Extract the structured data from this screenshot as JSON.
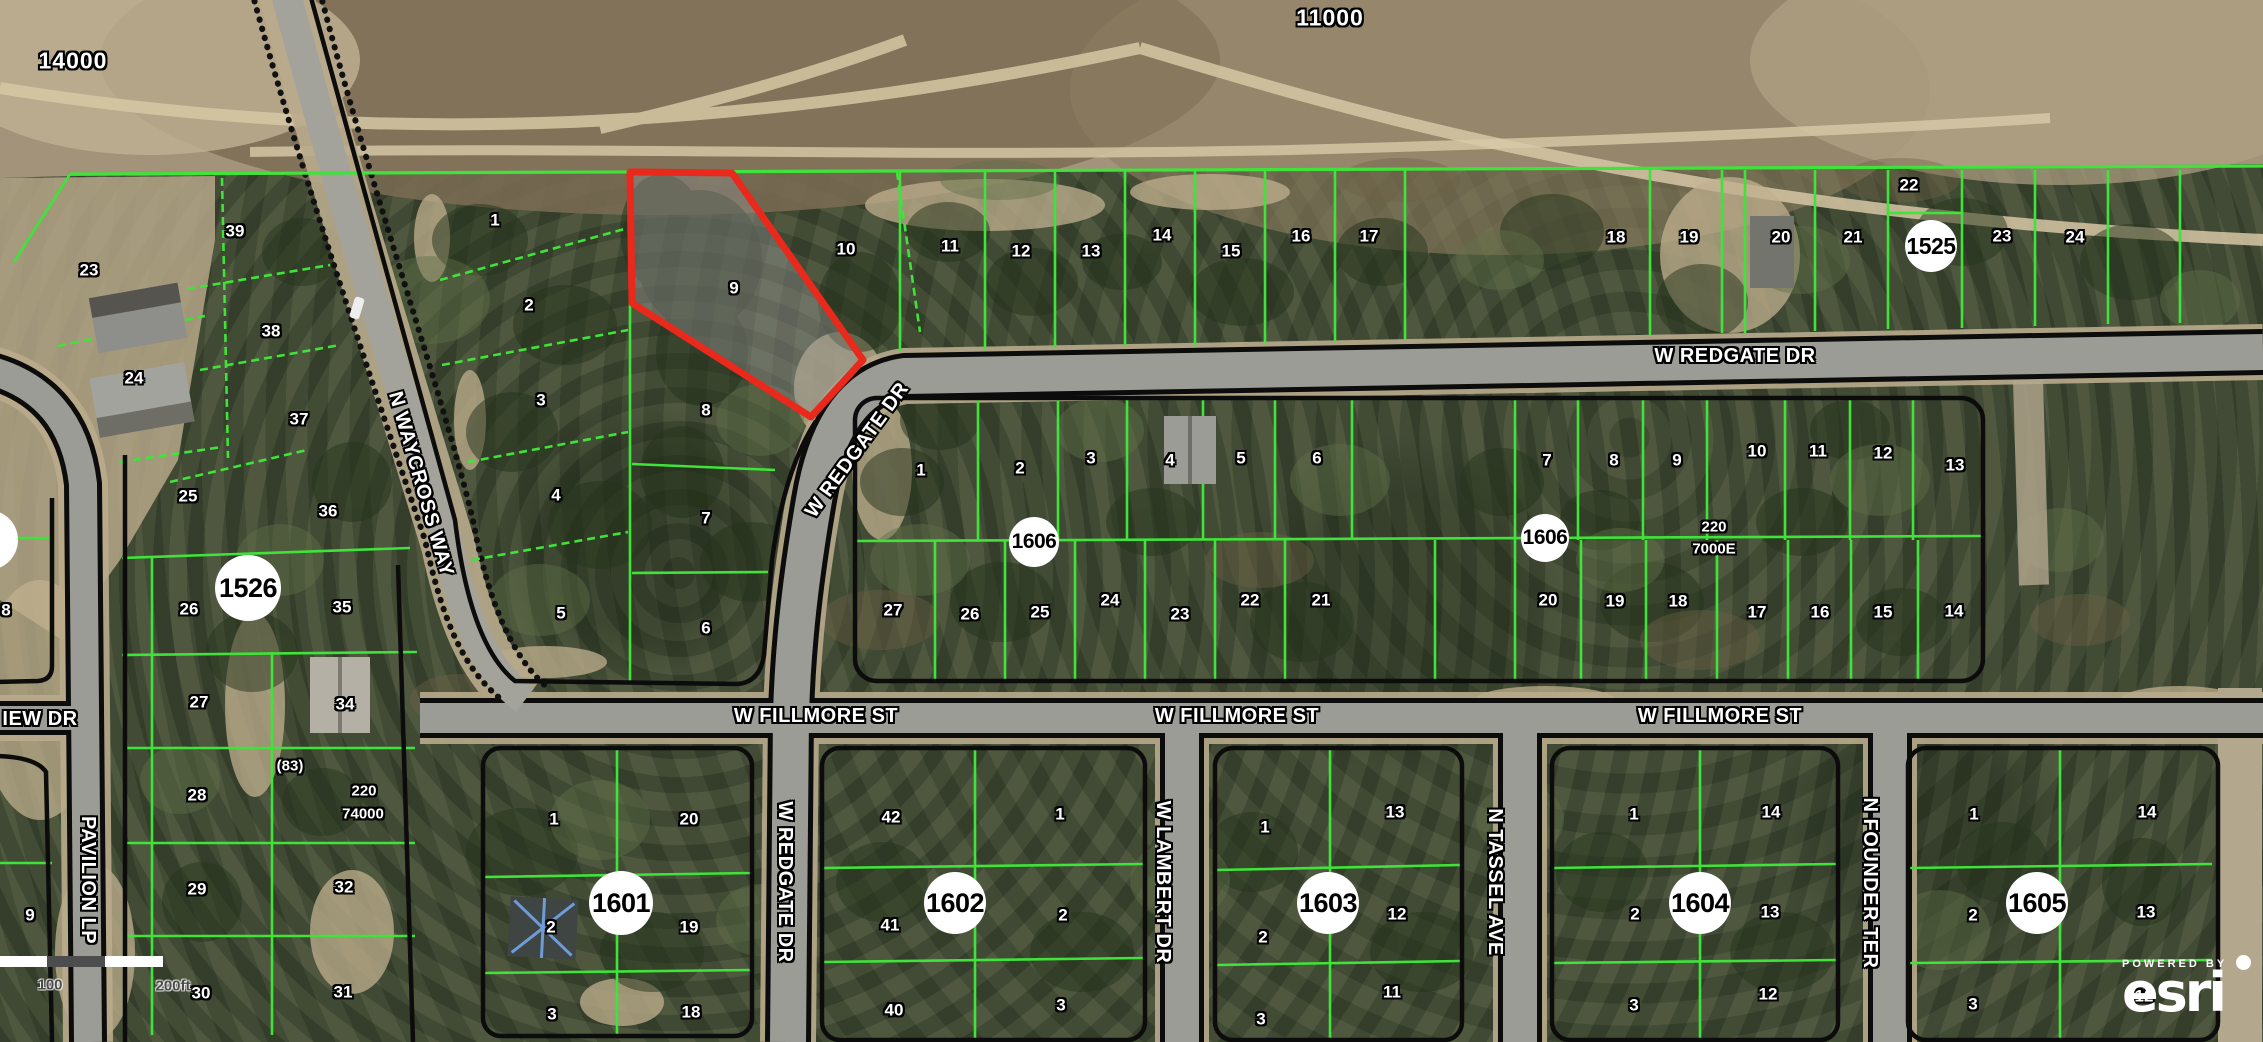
{
  "attribution": {
    "powered_by": "POWERED BY",
    "brand": "esri"
  },
  "scale_bar": {
    "labels": [
      {
        "t": "100",
        "x": 50,
        "y": 985
      },
      {
        "t": "200ft",
        "x": 173,
        "y": 986
      }
    ]
  },
  "colors": {
    "parcel_line": "#3fe339",
    "block_outline": "#0c0c0c",
    "highlight_stroke": "#e8291c",
    "highlight_fill": "rgba(150,150,150,0.42)",
    "road": "#9c9c96",
    "sand": "#c0b08f",
    "badge_bg": "#ffffff"
  },
  "highlighted_parcel": {
    "lot": "9"
  },
  "area_labels": [
    {
      "t": "14000",
      "x": 73,
      "y": 61
    },
    {
      "t": "11000",
      "x": 1330,
      "y": 18
    }
  ],
  "street_labels": [
    {
      "t": "N WAYCROSS WAY",
      "x": 421,
      "y": 484,
      "rot": 74
    },
    {
      "t": "W REDGATE DR",
      "x": 857,
      "y": 450,
      "rot": -54
    },
    {
      "t": "W REDGATE DR",
      "x": 1735,
      "y": 356,
      "rot": 0
    },
    {
      "t": "W REDGATE DR",
      "x": 785,
      "y": 882,
      "rot": 90
    },
    {
      "t": "W FILLMORE ST",
      "x": 816,
      "y": 716,
      "rot": 0
    },
    {
      "t": "W FILLMORE ST",
      "x": 1237,
      "y": 716,
      "rot": 0
    },
    {
      "t": "W FILLMORE ST",
      "x": 1720,
      "y": 716,
      "rot": 0
    },
    {
      "t": "W LAMBERT DR",
      "x": 1163,
      "y": 882,
      "rot": 90
    },
    {
      "t": "N TASSEL AVE",
      "x": 1495,
      "y": 882,
      "rot": 90
    },
    {
      "t": "N FOUNDER TER",
      "x": 1870,
      "y": 883,
      "rot": 90
    },
    {
      "t": "PAVILION LP",
      "x": 88,
      "y": 880,
      "rot": 90
    },
    {
      "t": "IEW DR",
      "x": 40,
      "y": 719,
      "rot": 0
    }
  ],
  "block_badges": [
    {
      "t": "1526",
      "x": 248,
      "y": 588,
      "r": 33
    },
    {
      "t": "1525",
      "x": 1931,
      "y": 246,
      "r": 26
    },
    {
      "t": "1606",
      "x": 1034,
      "y": 542,
      "r": 25
    },
    {
      "t": "1606",
      "x": 1545,
      "y": 538,
      "r": 24
    },
    {
      "t": "1601",
      "x": 621,
      "y": 903,
      "r": 32
    },
    {
      "t": "1602",
      "x": 955,
      "y": 903,
      "r": 31
    },
    {
      "t": "1603",
      "x": 1328,
      "y": 903,
      "r": 31
    },
    {
      "t": "1604",
      "x": 1700,
      "y": 903,
      "r": 31
    },
    {
      "t": "1605",
      "x": 2037,
      "y": 903,
      "r": 31
    }
  ],
  "ref_labels": [
    {
      "t": "(83)",
      "x": 290,
      "y": 766
    },
    {
      "t": "220",
      "x": 364,
      "y": 791
    },
    {
      "t": "74000",
      "x": 363,
      "y": 814
    },
    {
      "t": "220",
      "x": 1714,
      "y": 527
    },
    {
      "t": "7000E",
      "x": 1714,
      "y": 549
    }
  ],
  "lot_labels": [
    {
      "t": "23",
      "x": 89,
      "y": 270
    },
    {
      "t": "24",
      "x": 134,
      "y": 378
    },
    {
      "t": "39",
      "x": 235,
      "y": 231
    },
    {
      "t": "38",
      "x": 271,
      "y": 331
    },
    {
      "t": "37",
      "x": 299,
      "y": 419
    },
    {
      "t": "36",
      "x": 328,
      "y": 511
    },
    {
      "t": "35",
      "x": 342,
      "y": 607
    },
    {
      "t": "34",
      "x": 345,
      "y": 704
    },
    {
      "t": "25",
      "x": 188,
      "y": 496
    },
    {
      "t": "26",
      "x": 189,
      "y": 609
    },
    {
      "t": "27",
      "x": 199,
      "y": 702
    },
    {
      "t": "28",
      "x": 197,
      "y": 795
    },
    {
      "t": "29",
      "x": 197,
      "y": 889
    },
    {
      "t": "30",
      "x": 201,
      "y": 993
    },
    {
      "t": "31",
      "x": 343,
      "y": 992
    },
    {
      "t": "32",
      "x": 344,
      "y": 887
    },
    {
      "t": "9",
      "x": 30,
      "y": 915
    },
    {
      "t": "8",
      "x": 6,
      "y": 610
    },
    {
      "t": "1",
      "x": 495,
      "y": 220
    },
    {
      "t": "2",
      "x": 529,
      "y": 305
    },
    {
      "t": "3",
      "x": 541,
      "y": 400
    },
    {
      "t": "4",
      "x": 556,
      "y": 495
    },
    {
      "t": "5",
      "x": 561,
      "y": 613
    },
    {
      "t": "6",
      "x": 706,
      "y": 628
    },
    {
      "t": "7",
      "x": 706,
      "y": 518
    },
    {
      "t": "8",
      "x": 706,
      "y": 410
    },
    {
      "t": "9",
      "x": 734,
      "y": 288
    },
    {
      "t": "10",
      "x": 846,
      "y": 249
    },
    {
      "t": "11",
      "x": 950,
      "y": 246
    },
    {
      "t": "12",
      "x": 1021,
      "y": 251
    },
    {
      "t": "13",
      "x": 1091,
      "y": 251
    },
    {
      "t": "14",
      "x": 1162,
      "y": 235
    },
    {
      "t": "15",
      "x": 1231,
      "y": 251
    },
    {
      "t": "16",
      "x": 1301,
      "y": 236
    },
    {
      "t": "17",
      "x": 1369,
      "y": 236
    },
    {
      "t": "18",
      "x": 1616,
      "y": 237
    },
    {
      "t": "19",
      "x": 1689,
      "y": 237
    },
    {
      "t": "20",
      "x": 1781,
      "y": 237
    },
    {
      "t": "21",
      "x": 1853,
      "y": 237
    },
    {
      "t": "22",
      "x": 1909,
      "y": 185
    },
    {
      "t": "23",
      "x": 2002,
      "y": 236
    },
    {
      "t": "24",
      "x": 2075,
      "y": 237
    },
    {
      "t": "1",
      "x": 921,
      "y": 470
    },
    {
      "t": "2",
      "x": 1020,
      "y": 468
    },
    {
      "t": "3",
      "x": 1091,
      "y": 458
    },
    {
      "t": "4",
      "x": 1170,
      "y": 460
    },
    {
      "t": "5",
      "x": 1241,
      "y": 458
    },
    {
      "t": "6",
      "x": 1317,
      "y": 458
    },
    {
      "t": "7",
      "x": 1547,
      "y": 460
    },
    {
      "t": "8",
      "x": 1614,
      "y": 460
    },
    {
      "t": "9",
      "x": 1677,
      "y": 460
    },
    {
      "t": "10",
      "x": 1757,
      "y": 451
    },
    {
      "t": "11",
      "x": 1818,
      "y": 451
    },
    {
      "t": "12",
      "x": 1883,
      "y": 453
    },
    {
      "t": "13",
      "x": 1955,
      "y": 465
    },
    {
      "t": "27",
      "x": 893,
      "y": 610
    },
    {
      "t": "26",
      "x": 970,
      "y": 614
    },
    {
      "t": "25",
      "x": 1040,
      "y": 612
    },
    {
      "t": "24",
      "x": 1110,
      "y": 600
    },
    {
      "t": "23",
      "x": 1180,
      "y": 614
    },
    {
      "t": "22",
      "x": 1250,
      "y": 600
    },
    {
      "t": "21",
      "x": 1321,
      "y": 600
    },
    {
      "t": "20",
      "x": 1548,
      "y": 600
    },
    {
      "t": "19",
      "x": 1615,
      "y": 601
    },
    {
      "t": "18",
      "x": 1678,
      "y": 601
    },
    {
      "t": "17",
      "x": 1757,
      "y": 612
    },
    {
      "t": "16",
      "x": 1820,
      "y": 612
    },
    {
      "t": "15",
      "x": 1883,
      "y": 612
    },
    {
      "t": "14",
      "x": 1954,
      "y": 611
    },
    {
      "t": "1",
      "x": 554,
      "y": 819
    },
    {
      "t": "20",
      "x": 689,
      "y": 819
    },
    {
      "t": "2",
      "x": 551,
      "y": 927
    },
    {
      "t": "19",
      "x": 689,
      "y": 927
    },
    {
      "t": "3",
      "x": 552,
      "y": 1014
    },
    {
      "t": "18",
      "x": 691,
      "y": 1012
    },
    {
      "t": "42",
      "x": 891,
      "y": 817
    },
    {
      "t": "41",
      "x": 890,
      "y": 925
    },
    {
      "t": "40",
      "x": 894,
      "y": 1010
    },
    {
      "t": "1",
      "x": 1060,
      "y": 814
    },
    {
      "t": "2",
      "x": 1063,
      "y": 915
    },
    {
      "t": "3",
      "x": 1061,
      "y": 1005
    },
    {
      "t": "1",
      "x": 1265,
      "y": 827
    },
    {
      "t": "13",
      "x": 1395,
      "y": 812
    },
    {
      "t": "2",
      "x": 1263,
      "y": 937
    },
    {
      "t": "12",
      "x": 1397,
      "y": 914
    },
    {
      "t": "3",
      "x": 1261,
      "y": 1019
    },
    {
      "t": "11",
      "x": 1392,
      "y": 992
    },
    {
      "t": "1",
      "x": 1634,
      "y": 814
    },
    {
      "t": "14",
      "x": 1771,
      "y": 812
    },
    {
      "t": "2",
      "x": 1635,
      "y": 914
    },
    {
      "t": "13",
      "x": 1770,
      "y": 912
    },
    {
      "t": "3",
      "x": 1634,
      "y": 1005
    },
    {
      "t": "12",
      "x": 1768,
      "y": 994
    },
    {
      "t": "1",
      "x": 1974,
      "y": 814
    },
    {
      "t": "14",
      "x": 2147,
      "y": 812
    },
    {
      "t": "2",
      "x": 1973,
      "y": 915
    },
    {
      "t": "13",
      "x": 2146,
      "y": 912
    },
    {
      "t": "3",
      "x": 1973,
      "y": 1004
    },
    {
      "t": "12",
      "x": 2144,
      "y": 996
    }
  ]
}
